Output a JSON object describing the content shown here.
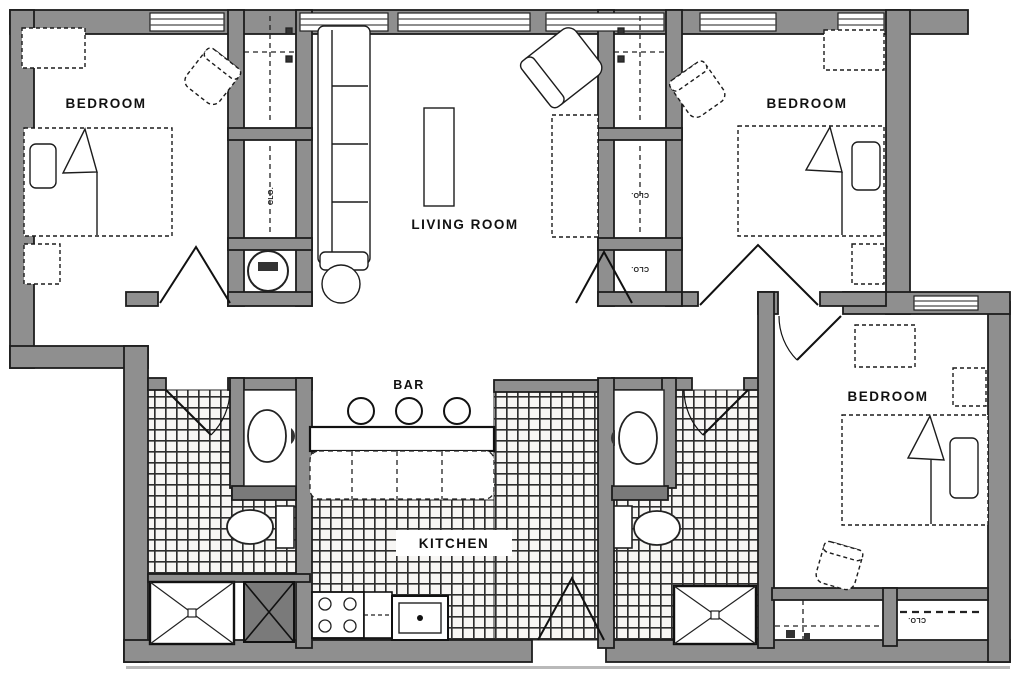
{
  "plan": {
    "labels": {
      "bedroom_top_left": "BEDROOM",
      "bedroom_top_right": "BEDROOM",
      "bedroom_right": "BEDROOM",
      "living_room": "LIVING ROOM",
      "bar": "BAR",
      "kitchen": "KITCHEN"
    },
    "closet_labels": {
      "left_hall_closet": "CLO.",
      "right_hall_closet": "CLO.",
      "right_hall_closet_lower": "CLO.",
      "bedroom_right_closet": "CLO."
    },
    "colors": {
      "wall_fill": "#8f8f8f",
      "wall_dark_fill": "#7a7a7a",
      "line": "#1d1d1d",
      "tile_line": "#2e2e2e",
      "label_text": "#111111",
      "background": "#ffffff"
    }
  }
}
